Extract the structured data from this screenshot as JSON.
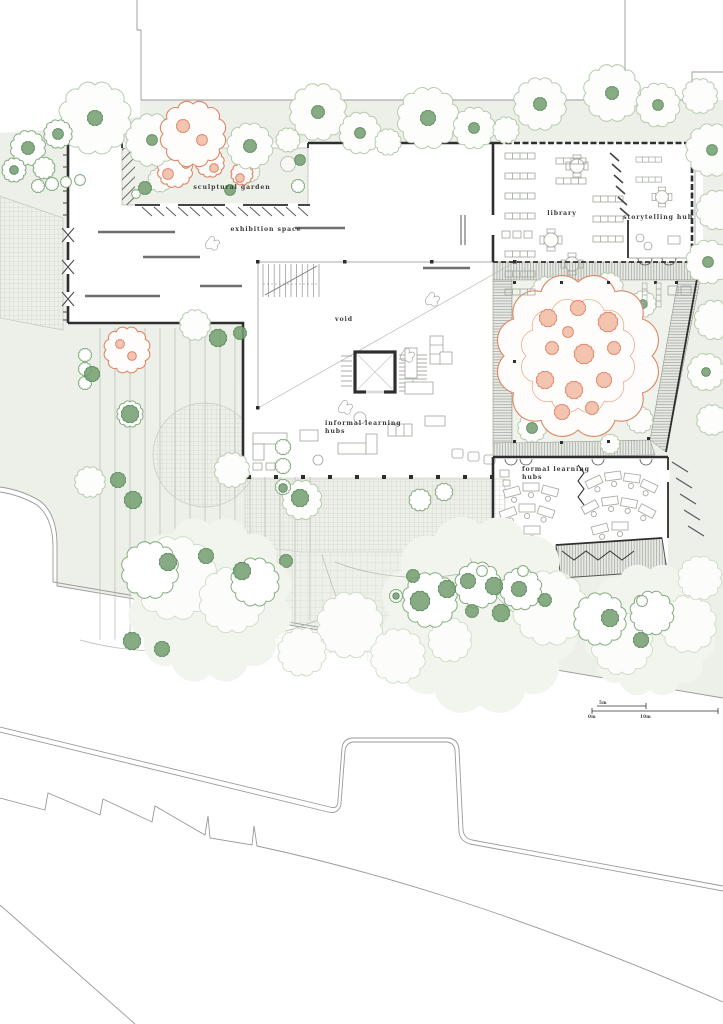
{
  "plan": {
    "rooms": {
      "sculptural_garden": "sculptural garden",
      "exhibition_space": "exhibition space",
      "library": "library",
      "storytelling_hub": "storytelling hub",
      "void": "void",
      "informal_learning_1": "informal learning",
      "informal_learning_2": "hubs",
      "formal_learning_1": "formal learning",
      "formal_learning_2": "hubs"
    },
    "scale_bar": {
      "m0": "0m",
      "m5": "5m",
      "m10": "10m"
    },
    "colors": {
      "wall": "#2e2e2e",
      "accent_orange": "#dd8565",
      "tree_green": "#76a072",
      "tree_light": "#b7cbb0",
      "site_fill": "#edf0e8"
    }
  }
}
